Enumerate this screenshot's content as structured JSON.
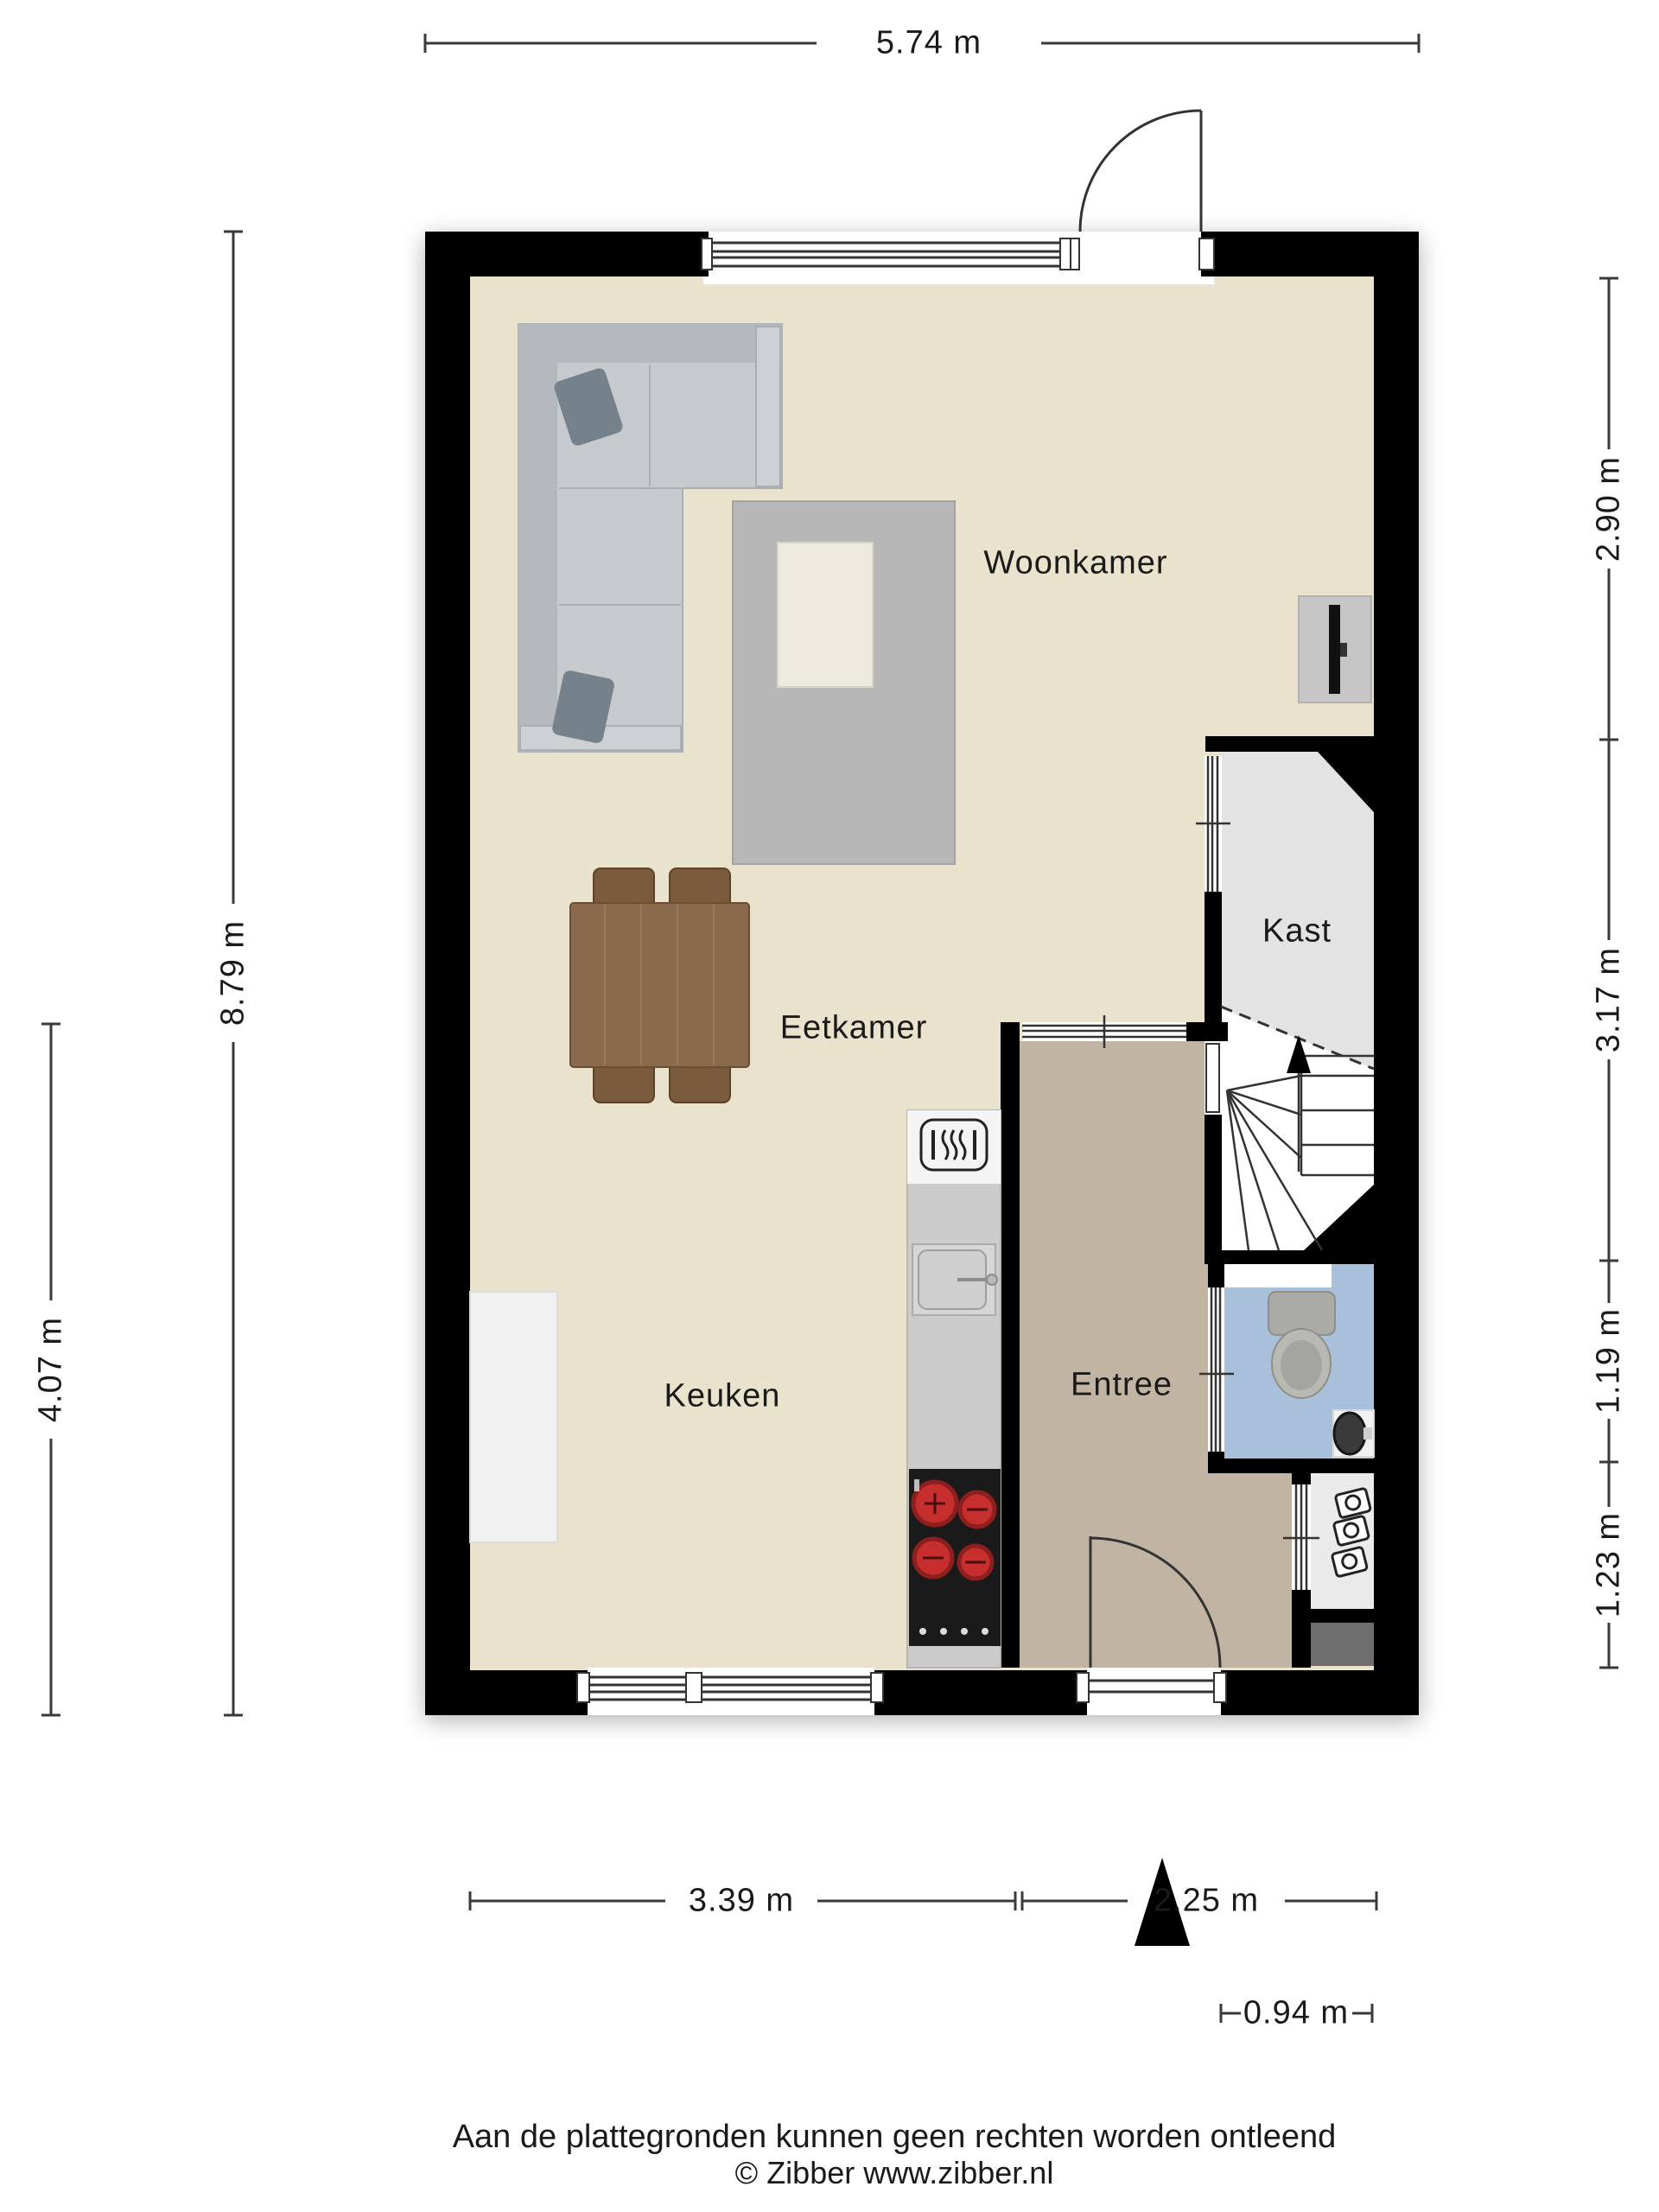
{
  "plan": {
    "type": "floorplan",
    "rooms": {
      "woonkamer": "Woonkamer",
      "kast": "Kast",
      "eetkamer": "Eetkamer",
      "keuken": "Keuken",
      "entree": "Entree"
    },
    "dims": {
      "top": "5.74 m",
      "right_1": "2.90 m",
      "right_2": "3.17 m",
      "right_3": "1.19 m",
      "right_4": "1.23 m",
      "left_1": "8.79 m",
      "left_2": "4.07 m",
      "bottom_1": "3.39 m",
      "bottom_2": "2.25 m",
      "bottom_sub": "0.94 m"
    },
    "footer": {
      "disclaimer": "Aan de plattegronden kunnen geen rechten worden ontleend",
      "copyright": "© Zibber www.zibber.nl"
    },
    "colors": {
      "wall": "#000000",
      "floor_main": "#E9E3CD",
      "floor_entree": "#C2B4A3",
      "floor_kast": "#E3E3E3",
      "floor_stairs": "#FFFFFF",
      "floor_bathroom": "#A9C0DA",
      "floor_niche": "#EAEAEA",
      "meter_block": "#6E6E6E",
      "counter": "#CBCBCB",
      "stove": "#1A1A1A",
      "burner_red": "#C72F2F",
      "sofa": "#C6CACC",
      "rug": "#B7B7B7",
      "table_wood": "#8A6A4C",
      "dimension_line": "#3a3a3a"
    },
    "icons": {
      "entrance_arrow": "entrance-arrow-icon",
      "stairs_up_arrow": "stairs-up-arrow-icon",
      "extractor_hood": "extractor-hood-icon",
      "door_swing": "door-swing-icon"
    }
  }
}
